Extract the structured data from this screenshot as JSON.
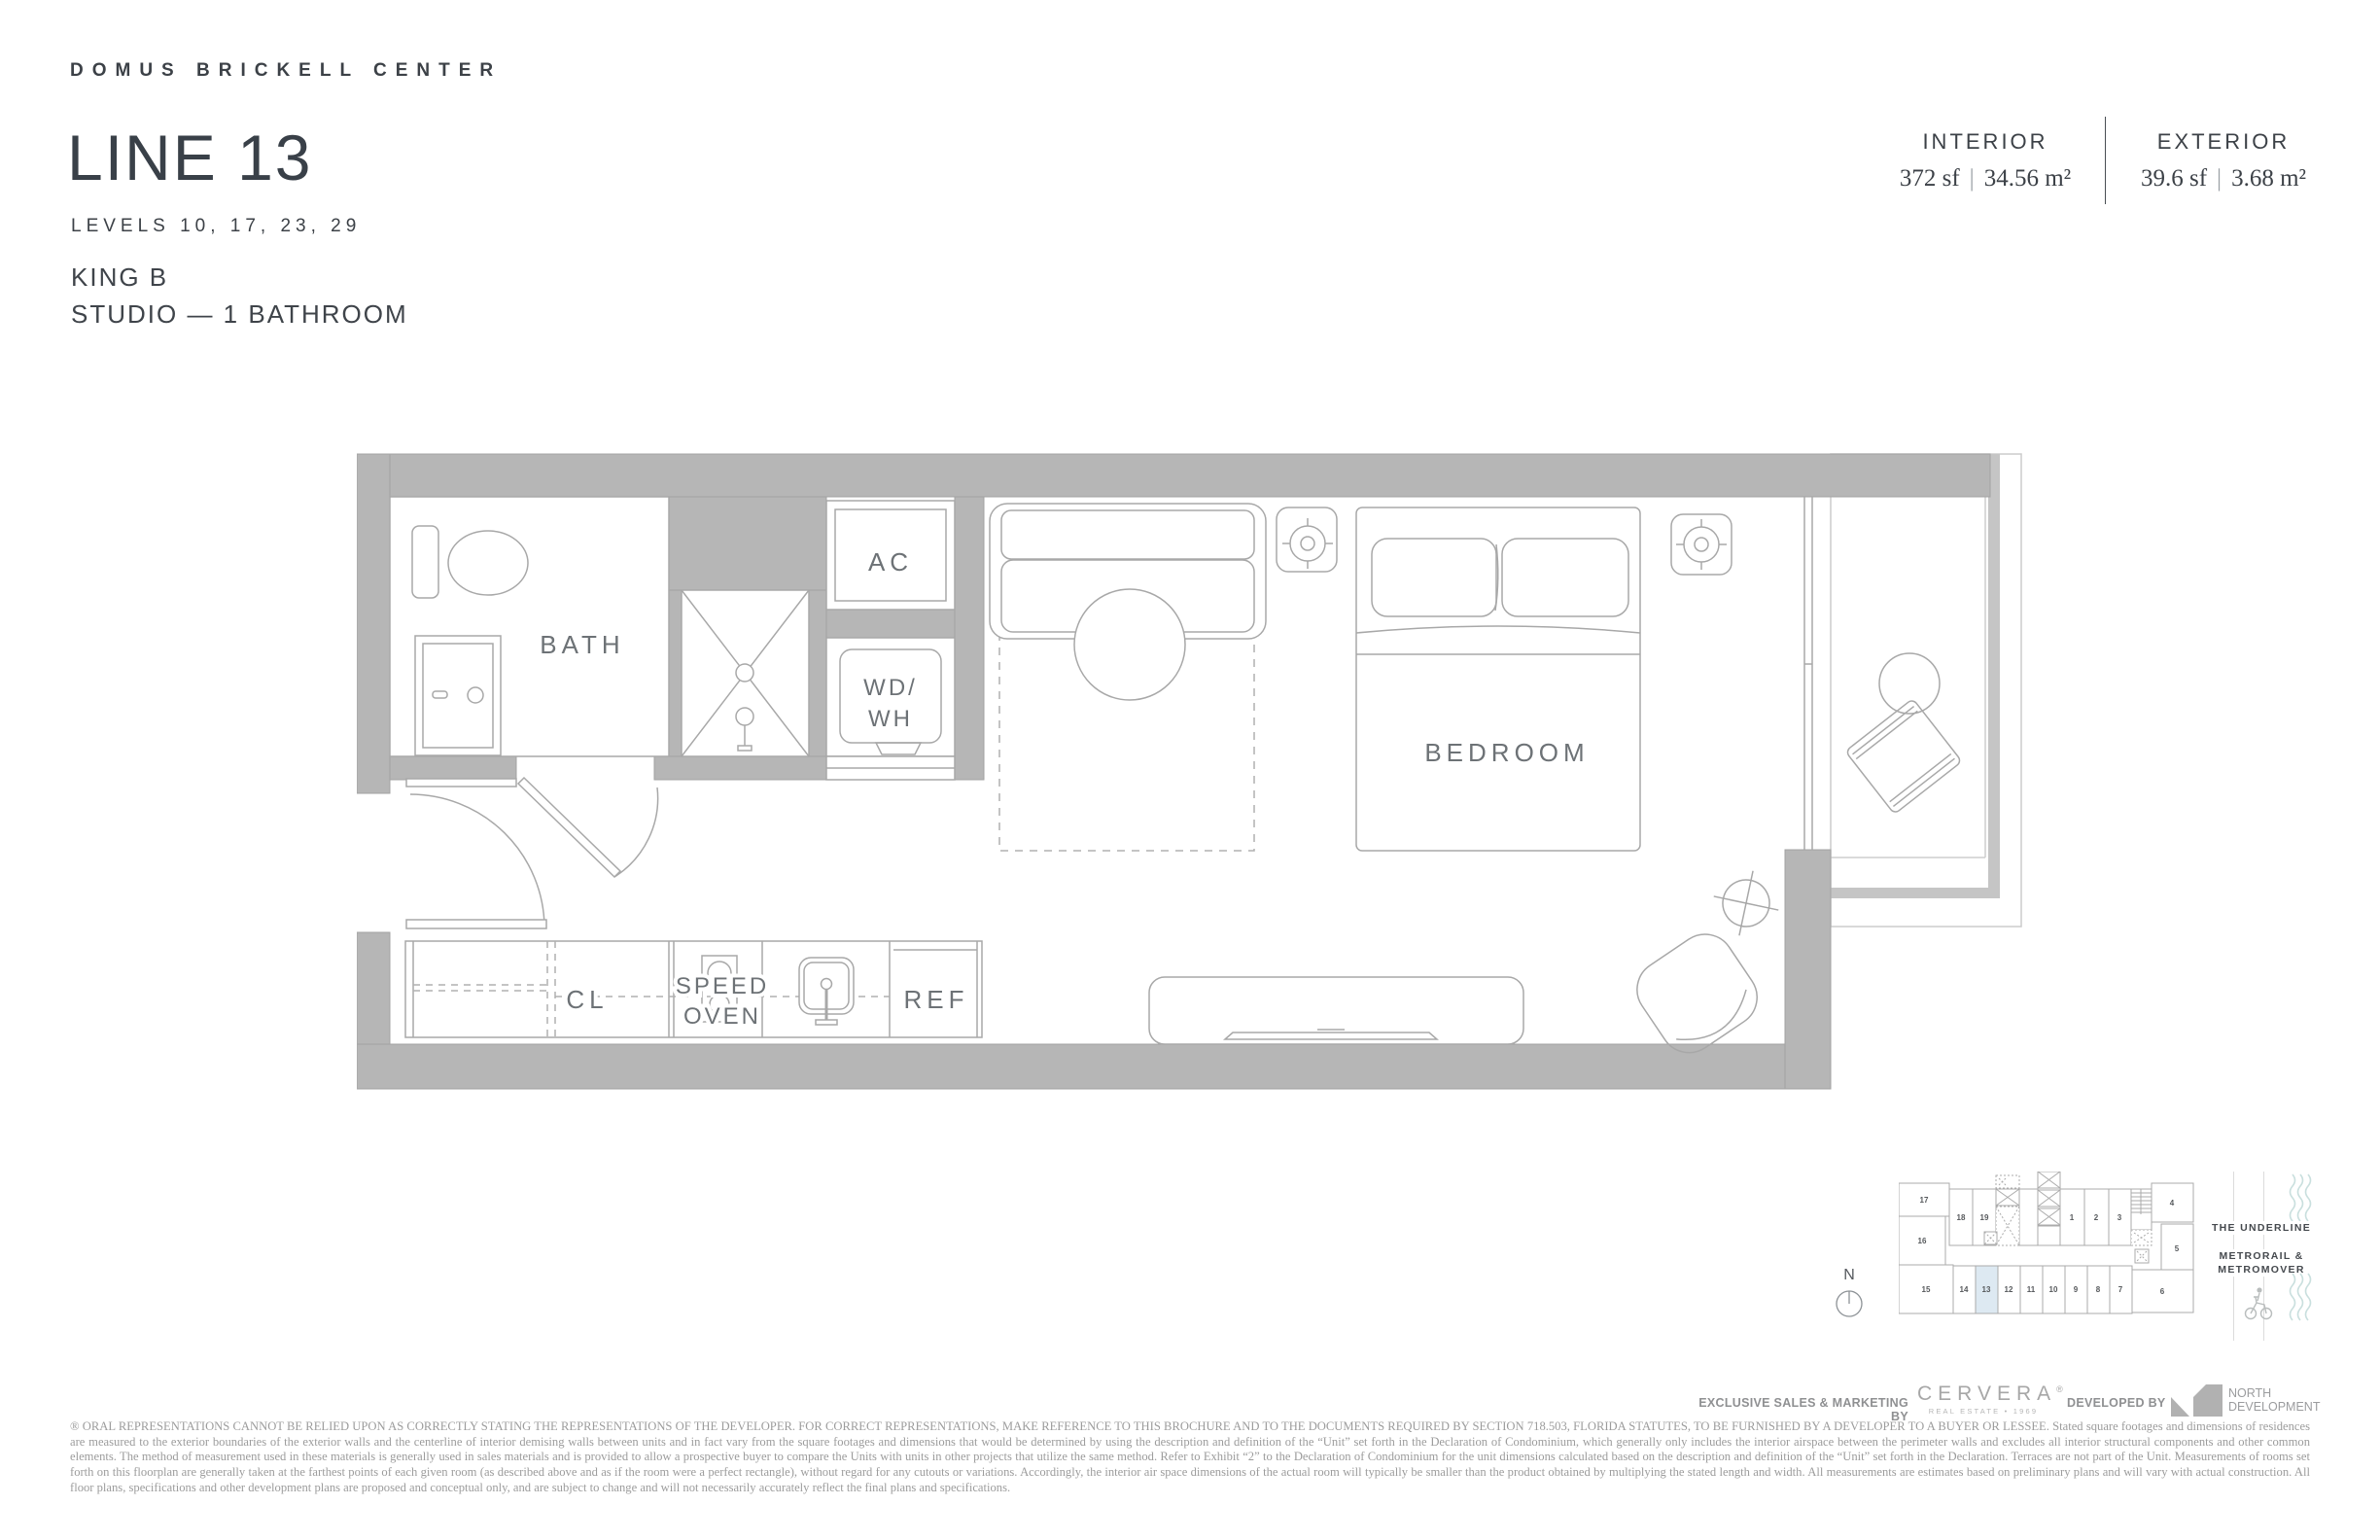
{
  "header": {
    "brand": "DOMUS BRICKELL CENTER",
    "line_title": "LINE 13",
    "levels": "LEVELS 10, 17, 23, 29",
    "unit_type": "KING B",
    "unit_config": "STUDIO — 1 BATHROOM"
  },
  "stats": {
    "separator": "|",
    "interior": {
      "label": "INTERIOR",
      "sf": "372 sf",
      "m2": "34.56 m²"
    },
    "exterior": {
      "label": "EXTERIOR",
      "sf": "39.6 sf",
      "m2": "3.68 m²"
    }
  },
  "floorplan": {
    "labels": {
      "bath": "BATH",
      "ac": "AC",
      "wd": "WD/",
      "wh": "WH",
      "bedroom": "BEDROOM",
      "cl": "CL",
      "speed": "SPEED",
      "oven": "OVEN",
      "ref": "REF"
    }
  },
  "keyplan": {
    "highlighted_unit": "13",
    "units": {
      "u1": "1",
      "u2": "2",
      "u3": "3",
      "u4": "4",
      "u5": "5",
      "u6": "6",
      "u7": "7",
      "u8": "8",
      "u9": "9",
      "u10": "10",
      "u11": "11",
      "u12": "12",
      "u13": "13",
      "u14": "14",
      "u15": "15",
      "u16": "16",
      "u17": "17",
      "u18": "18",
      "u19": "19"
    },
    "compass": "N",
    "underline_label": "THE UNDERLINE",
    "metro_line1": "METRORAIL &",
    "metro_line2": "METROMOVER"
  },
  "footer": {
    "sales_label": "EXCLUSIVE SALES & MARKETING BY",
    "cervera_word": "CERVERA",
    "cervera_reg": "®",
    "cervera_sub": "REAL ESTATE • 1969",
    "developed_label": "DEVELOPED BY",
    "developer_line1": "NORTH",
    "developer_line2": "DEVELOPMENT",
    "disclaimer": "® ORAL REPRESENTATIONS CANNOT BE RELIED UPON AS CORRECTLY STATING THE REPRESENTATIONS OF THE DEVELOPER. FOR CORRECT REPRESENTATIONS, MAKE REFERENCE TO THIS BROCHURE AND TO THE DOCUMENTS REQUIRED BY SECTION 718.503, FLORIDA STATUTES, TO BE FURNISHED BY A DEVELOPER TO A BUYER OR LESSEE. Stated square footages and dimensions of residences are measured to the exterior boundaries of the exterior walls and the centerline of interior demising walls between units and in fact vary from the square footages and dimensions that would be determined by using the description and definition of the “Unit” set forth in the Declaration of Condominium, which generally only includes the interior airspace between the perimeter walls and excludes all interior structural components and other common elements.  The method of measurement used in these materials is generally used in sales materials and is provided to allow a prospective buyer to compare the Units with units in other projects that utilize the same method. Refer to Exhibit “2” to the Declaration of Condominium for the unit dimensions calculated based on the description and definition of the “Unit” set forth in the Declaration. Terraces are not part of the Unit.  Measurements of rooms set forth on this floorplan are generally taken at the farthest points of each given room (as described above and as if the room were a perfect rectangle), without regard for any cutouts or variations.  Accordingly, the interior air space dimensions of the actual room will typically be smaller than the product obtained by multiplying the stated length and width.  All measurements are estimates based on preliminary plans and will vary with actual construction. All floor plans, specifications and other development plans are proposed and conceptual only, and are subject to change and will not necessarily accurately reflect the final plans and specifications."
  },
  "colors": {
    "wall_gray": "#b6b6b6",
    "slab_gray": "#c5c5c5",
    "line_gray": "#a8a8a8",
    "label_gray": "#6d7276",
    "header_dark": "#394048",
    "highlight_blue": "#dde9f2",
    "wave_teal": "#c9dfde"
  }
}
